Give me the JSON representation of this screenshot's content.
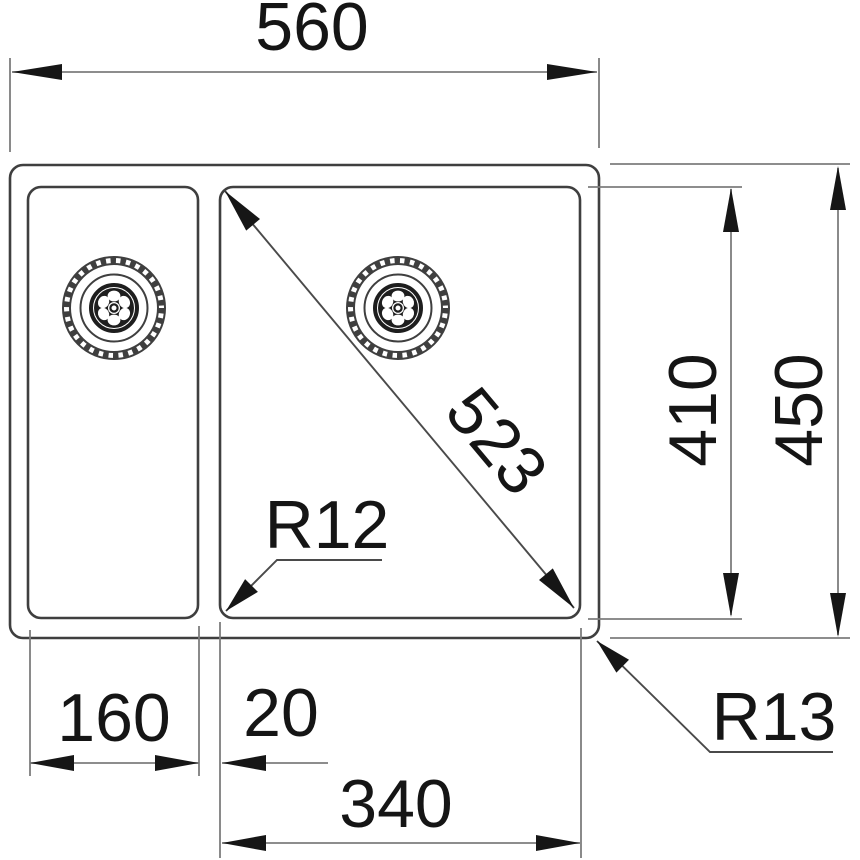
{
  "dims": {
    "overall_width": "560",
    "diagonal": "523",
    "bowl_depth": "410",
    "overall_depth": "450",
    "left_bowl_width": "160",
    "gap": "20",
    "main_bowl_width": "340",
    "bowl_corner_radius": "R12",
    "outer_corner_radius": "R13"
  },
  "colors": {
    "background": "#ffffff",
    "outline": "#3f3f3f",
    "dimension_line": "#7d7d7d",
    "ink": "#151515"
  }
}
